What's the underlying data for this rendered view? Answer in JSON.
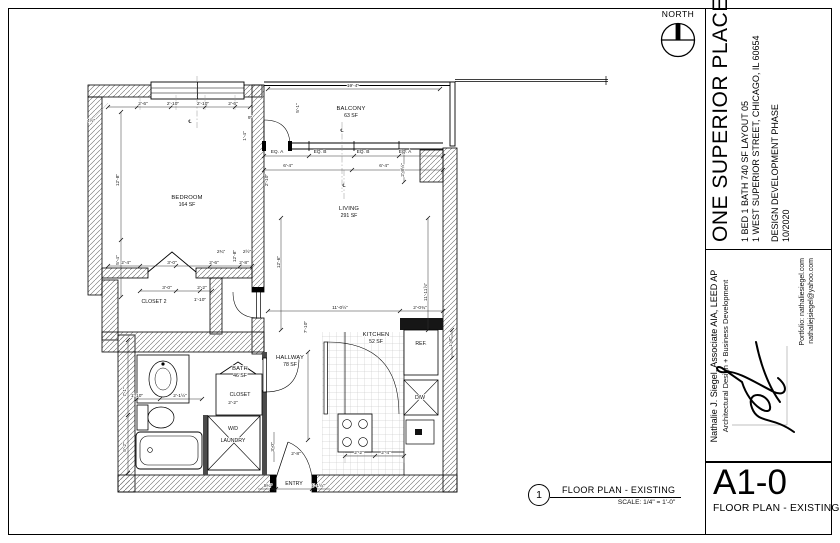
{
  "north": {
    "label": "NORTH"
  },
  "title_block": {
    "project": "ONE SUPERIOR PLACE",
    "subtitle1": "1 BED 1 BATH 740 SF LAYOUT 05",
    "subtitle2": "1 WEST SUPERIOR STREET, CHICAGO, IL 60654",
    "phase": "DESIGN DEVELOPMENT PHASE",
    "date": "10/2020",
    "architect_name": "Nathalie J. Siegel, Associate AIA, LEED AP",
    "architect_role": "Architectural Design + Business Development",
    "portfolio": "Portfolio: nathaliesiegel.com",
    "email": "nathaliejsiegel@yahoo.com",
    "sheet_number": "A1-0",
    "sheet_name": "FLOOR PLAN - EXISTING"
  },
  "view_title": {
    "number": "1",
    "label": "FLOOR PLAN - EXISTING",
    "scale": "SCALE: 1/4\" = 1'-0\""
  },
  "plan": {
    "rooms": [
      {
        "name": "BEDROOM",
        "area": "164 SF"
      },
      {
        "name": "BALCONY",
        "area": "63 SF"
      },
      {
        "name": "LIVING",
        "area": "291 SF"
      },
      {
        "name": "KITCHEN",
        "area": "52 SF"
      },
      {
        "name": "BATH",
        "area": "46 SF"
      },
      {
        "name": "HALLWAY",
        "area": "78 SF"
      },
      {
        "name": "CLOSET 2"
      },
      {
        "name": "CLOSET"
      },
      {
        "name": "W/D"
      },
      {
        "name": "LAUNDRY"
      },
      {
        "name": "ENTRY"
      },
      {
        "name": "REF."
      },
      {
        "name": "D/W"
      }
    ],
    "dims": [
      {
        "t": "19'-4\"",
        "x": 353,
        "y": 87
      },
      {
        "t": "2'-6\"",
        "x": 143,
        "y": 105
      },
      {
        "t": "2'-10\"",
        "x": 173,
        "y": 105
      },
      {
        "t": "2'-10\"",
        "x": 203,
        "y": 105
      },
      {
        "t": "2'-6\"",
        "x": 233,
        "y": 105
      },
      {
        "t": "4½\"",
        "x": 91,
        "y": 122
      },
      {
        "t": "9\"",
        "x": 250,
        "y": 119
      },
      {
        "t": "EQ. A",
        "x": 277,
        "y": 153
      },
      {
        "t": "EQ. B",
        "x": 320,
        "y": 153
      },
      {
        "t": "EQ. B",
        "x": 363,
        "y": 153
      },
      {
        "t": "EQ. A",
        "x": 405,
        "y": 153
      },
      {
        "t": "6'-4\"",
        "x": 288,
        "y": 167
      },
      {
        "t": "6'-4\"",
        "x": 384,
        "y": 167
      },
      {
        "t": "5'-1\"",
        "x": 299,
        "y": 108,
        "r": 1
      },
      {
        "t": "2'-10\"",
        "x": 268,
        "y": 180,
        "r": 1
      },
      {
        "t": "12'-8\"",
        "x": 119,
        "y": 180,
        "r": 1
      },
      {
        "t": "5'-4\"",
        "x": 119,
        "y": 260,
        "r": 1
      },
      {
        "t": "2'-4\"",
        "x": 126,
        "y": 264
      },
      {
        "t": "3'-0\"",
        "x": 172,
        "y": 264
      },
      {
        "t": "2'-6\"",
        "x": 214,
        "y": 264
      },
      {
        "t": "2'-8\"",
        "x": 244,
        "y": 264
      },
      {
        "t": "3'-0\"",
        "x": 167,
        "y": 289
      },
      {
        "t": "2'-2\"",
        "x": 202,
        "y": 289
      },
      {
        "t": "1'-10\"",
        "x": 200,
        "y": 301
      },
      {
        "t": "2¾\"",
        "x": 221,
        "y": 253
      },
      {
        "t": "2½\"",
        "x": 247,
        "y": 253
      },
      {
        "t": "1'-4\"",
        "x": 246,
        "y": 136,
        "r": 1
      },
      {
        "t": "12'-8\"",
        "x": 236,
        "y": 256,
        "r": 1
      },
      {
        "t": "12'-6\"",
        "x": 280,
        "y": 262,
        "r": 1
      },
      {
        "t": "11'-0½\"",
        "x": 340,
        "y": 309
      },
      {
        "t": "11'-11⅞\"",
        "x": 427,
        "y": 292,
        "r": 1
      },
      {
        "t": "2'-8½\"",
        "x": 404,
        "y": 170,
        "r": 1
      },
      {
        "t": "2'-0¾\"",
        "x": 420,
        "y": 309
      },
      {
        "t": "1'-8\"",
        "x": 452,
        "y": 342,
        "r": 1
      },
      {
        "t": "7'-10\"",
        "x": 307,
        "y": 327,
        "r": 1
      },
      {
        "t": "1'-10\"",
        "x": 137,
        "y": 397
      },
      {
        "t": "2'-1½\"",
        "x": 180,
        "y": 397
      },
      {
        "t": "2'-2\"",
        "x": 233,
        "y": 404
      },
      {
        "t": "3'-0\"",
        "x": 274,
        "y": 447,
        "r": 1
      },
      {
        "t": "2'-8\"",
        "x": 296,
        "y": 455
      },
      {
        "t": "2'-2\"",
        "x": 359,
        "y": 454
      },
      {
        "t": "2'-4\"",
        "x": 386,
        "y": 454
      },
      {
        "t": "8¼\"",
        "x": 268,
        "y": 487
      },
      {
        "t": "1'-1½\"",
        "x": 318,
        "y": 487
      },
      {
        "t": "7'-1\"",
        "x": 126,
        "y": 392,
        "r": 1
      },
      {
        "t": "5'-2\"",
        "x": 126,
        "y": 447,
        "r": 1
      },
      {
        "t": "℄",
        "x": 190,
        "y": 123
      },
      {
        "t": "℄",
        "x": 342,
        "y": 132
      },
      {
        "t": "℄",
        "x": 344,
        "y": 187
      }
    ]
  }
}
